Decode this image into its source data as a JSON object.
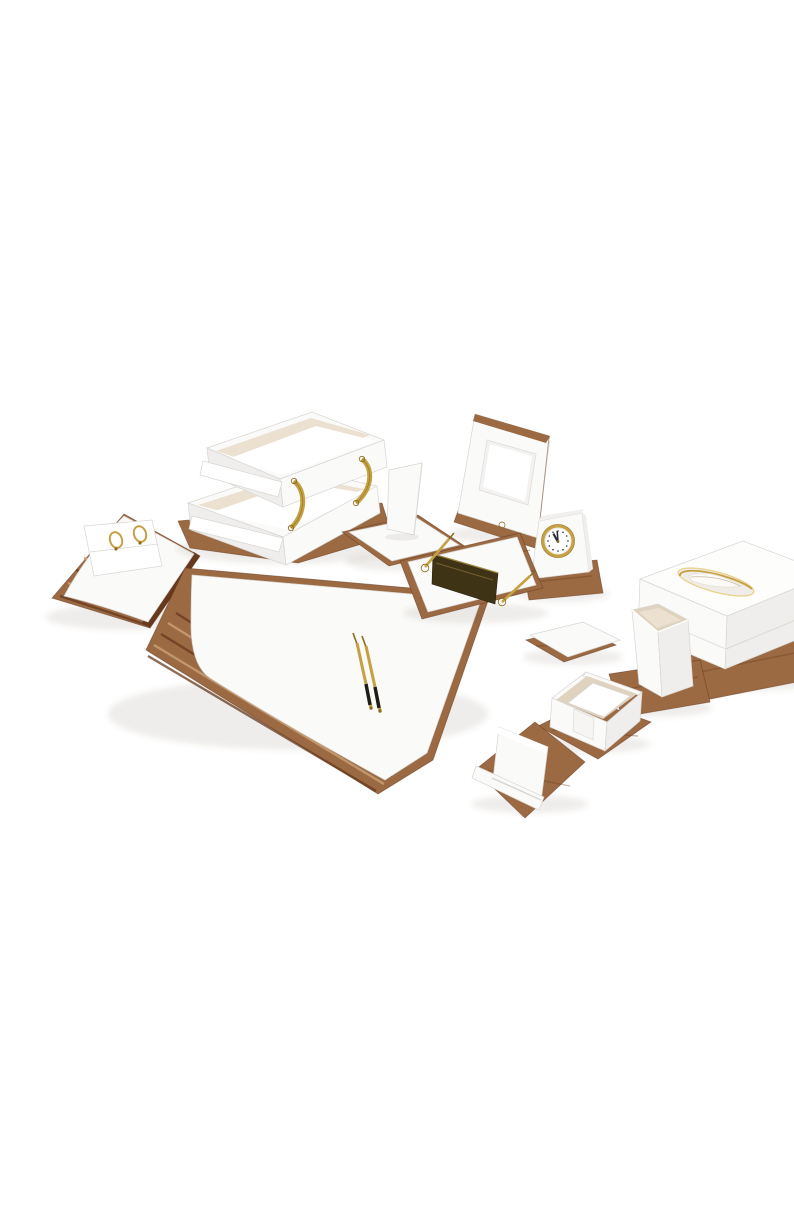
{
  "scene": {
    "title": "White leather desk organizer set",
    "description": "Product photo of a luxury desk accessory set in white leather with walnut wood bases and gold hardware, arranged diagonally on a plain white background: slant memo holder, double document tray, photo frame, phone stand, desk clock, desk pad with two gold pens, pen stand with nameplate, tissue box with feather, pencil cup, coaster, sticky note holder and business card holder."
  },
  "palette": {
    "background": "#ffffff",
    "leather": "#fafaf9",
    "leather_dim": "#efeeec",
    "leather_shadow": "#e4e2df",
    "paper": "#ffffff",
    "suede": "#ece1d1",
    "suede_dim": "#dfd2bf",
    "wood": "#9b6942",
    "wood_light": "#c59b72",
    "wood_dark": "#66391e",
    "gold": "#c6a144",
    "gold_light": "#e9d391",
    "gold_dark": "#8c6a1c",
    "plate": "#3f3316",
    "pen_black": "#1f1d1a",
    "hand": "#2a2d3a",
    "dial": "#ffffff",
    "edge_line": "#d8d6d2",
    "shadow_color": "rgba(90,70,50,0.10)"
  },
  "clock": {
    "time": "11:58"
  },
  "items": [
    {
      "id": "memo-holder",
      "label": "Slant memo holder with two gold ring clips and paper sheets"
    },
    {
      "id": "document-tray",
      "label": "Double letter tray with curved gold risers"
    },
    {
      "id": "photo-frame",
      "label": "Desk photo frame with wood edge and gold stud"
    },
    {
      "id": "phone-stand",
      "label": "Phone stand with leaning back plate"
    },
    {
      "id": "desk-clock",
      "label": "Desk clock with gold bezel, time about 11:58"
    },
    {
      "id": "desk-pad",
      "label": "Desk pad blotter with striped wood edge and two gold pens"
    },
    {
      "id": "pen-stand",
      "label": "Pen stand with bronze nameplate and two gold pens"
    },
    {
      "id": "tissue-box",
      "label": "Tissue box cover with gold-rimmed oval opening and white feather"
    },
    {
      "id": "pencil-cup",
      "label": "Square pencil cup"
    },
    {
      "id": "coaster",
      "label": "Square coaster pad"
    },
    {
      "id": "sticky-note-holder",
      "label": "Sticky note holder with white paper block"
    },
    {
      "id": "card-holder",
      "label": "Business card holder"
    }
  ]
}
